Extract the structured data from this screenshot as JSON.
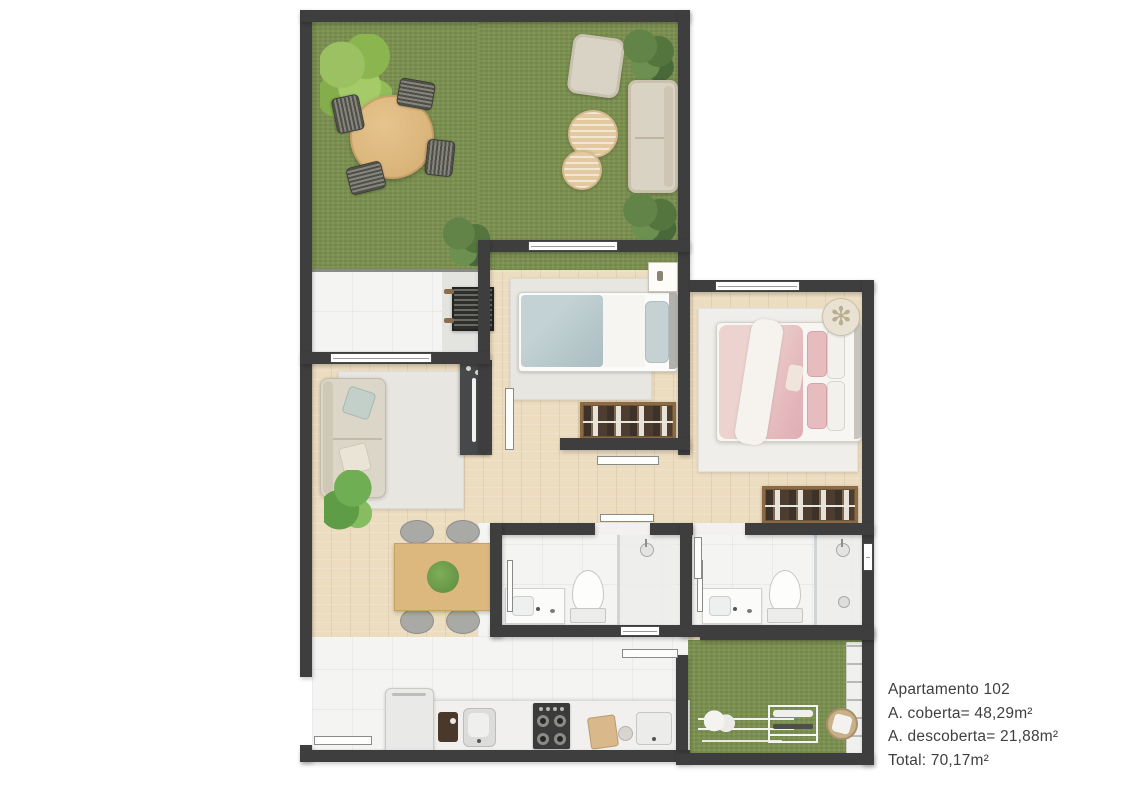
{
  "info_panel": {
    "line1": "Apartamento 102",
    "line2": "A. coberta= 48,29m²",
    "line3": "A. descoberta= 21,88m²",
    "line4": "Total: 70,17m²"
  },
  "colors": {
    "wall": "#3e3e3e",
    "grass": "#7c9150",
    "wood_floor": "#ecdcc0",
    "tile": "#f4f4f3",
    "rug": "#e8e6e1",
    "sofa_beige": "#d9d3c6",
    "table_wood": "#dcb87e",
    "chair_gray": "#a9a9a5",
    "bed_blue": "#b7c8cb",
    "bed_pink": "#e5b9bd",
    "wardrobe": "#8b6b46",
    "counter": "#f1f0ee",
    "appliance_dark": "#3b3b3b",
    "text": "#3f3f3f"
  }
}
